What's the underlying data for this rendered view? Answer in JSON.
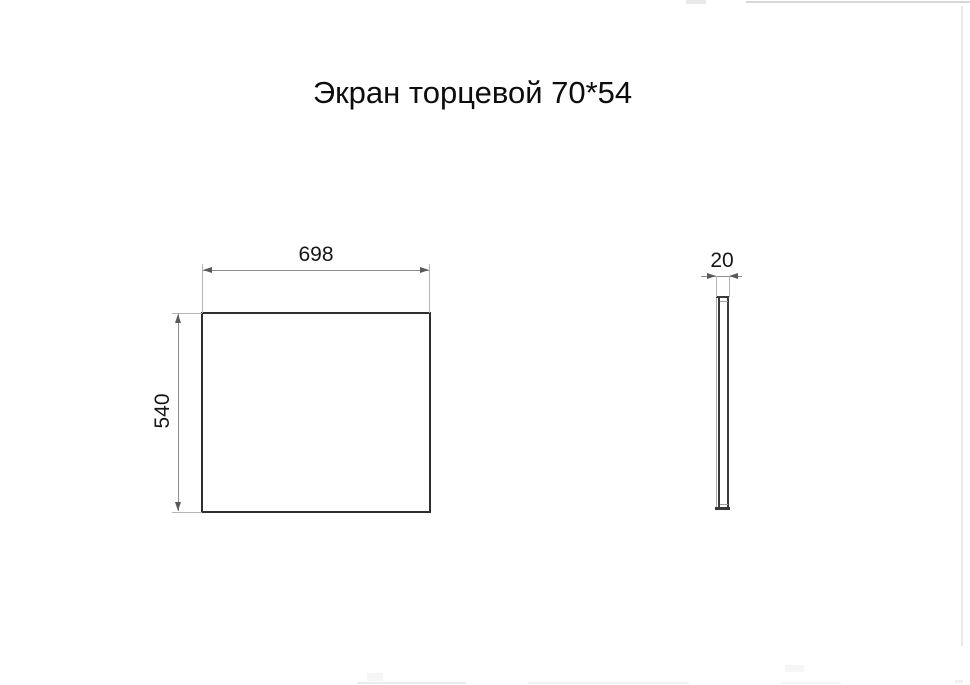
{
  "title": "Экран торцевой 70*54",
  "views": {
    "front": {
      "label": "front-view",
      "width_dim": "698",
      "height_dim": "540"
    },
    "side": {
      "label": "side-view",
      "thickness_dim": "20"
    }
  },
  "colors": {
    "background": "#ffffff",
    "outline": "#2e2e2e",
    "dimension_line": "#8c8c8c",
    "extension_line": "#b5b5b5",
    "arrow": "#5a5a5a",
    "text": "#111111",
    "page_edge_artifact": "#d7d7d7"
  }
}
